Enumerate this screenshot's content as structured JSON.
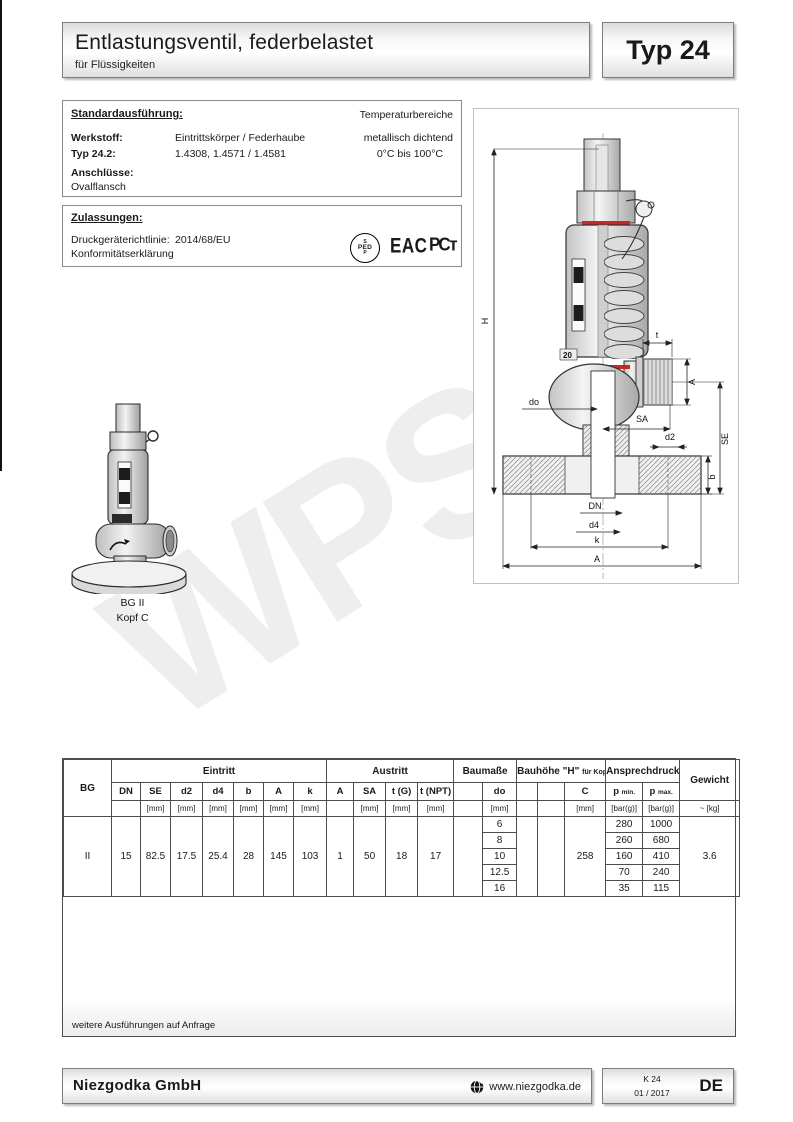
{
  "header": {
    "title": "Entlastungsventil, federbelastet",
    "subtitle": "für Flüssigkeiten",
    "type_label": "Typ 24"
  },
  "standard": {
    "heading": "Standardausführung:",
    "temp_heading": "Temperaturbereiche",
    "werkstoff_label": "Werkstoff:",
    "werkstoff_value": "Eintrittskörper / Federhaube",
    "werkstoff_right": "metallisch dichtend",
    "typ_label": "Typ 24.2:",
    "typ_value": "1.4308, 1.4571 / 1.4581",
    "typ_right": "0°C bis 100°C",
    "anschluesse_label": "Anschlüsse:",
    "anschluesse_value": "Ovalflansch"
  },
  "approvals": {
    "heading": "Zulassungen:",
    "directive_label": "Druckgeräterichtlinie:",
    "directive_value": "2014/68/EU",
    "conformity": "Konformitätserklärung",
    "ped_top": "S",
    "ped_mid": "PED",
    "ped_bottom": "P",
    "eac": "EAC",
    "pct": "РСт"
  },
  "drawing": {
    "labels": {
      "H": "H",
      "t": "t",
      "A_outlet": "A",
      "do": "do",
      "SA": "SA",
      "SE": "SE",
      "d2": "d2",
      "b": "b",
      "DN": "DN",
      "d4": "d4",
      "k": "k",
      "A_bottom": "A",
      "tag": "20"
    }
  },
  "small_drawing": {
    "caption1": "BG II",
    "caption2": "Kopf C"
  },
  "watermark": "WPS",
  "table": {
    "groups": {
      "bg": "BG",
      "eintritt": "Eintritt",
      "austritt": "Austritt",
      "baumasse": "Baumaße",
      "bauhoehe": "Bauhöhe \"H\"",
      "bauhoehe_small": "für Kopf",
      "ansprechdruck": "Ansprechdruck",
      "gewicht": "Gewicht"
    },
    "subs": {
      "dn": "DN",
      "se": "SE",
      "d2": "d2",
      "d4": "d4",
      "b": "b",
      "a": "A",
      "k": "k",
      "a2": "A",
      "sa": "SA",
      "tg": "t (G)",
      "tnpt": "t (NPT)",
      "do": "do",
      "c": "C",
      "pmin_p": "p",
      "pmin_sub": "min.",
      "pmax_p": "p",
      "pmax_sub": "max."
    },
    "units": {
      "mm": "[mm]",
      "bar": "[bar(g)]",
      "kg": "~ [kg]"
    },
    "row": {
      "bg": "II",
      "dn": "15",
      "se": "82.5",
      "d2": "17.5",
      "d4": "25.4",
      "b": "28",
      "a": "145",
      "k": "103",
      "a2": "1",
      "sa": "50",
      "tg": "18",
      "tnpt": "17",
      "c": "258",
      "weight": "3.6"
    },
    "do_values": [
      "6",
      "8",
      "10",
      "12.5",
      "16"
    ],
    "p_min": [
      "280",
      "260",
      "160",
      "70",
      "35"
    ],
    "p_max": [
      "1000",
      "680",
      "410",
      "240",
      "115"
    ],
    "note": "weitere Ausführungen auf Anfrage"
  },
  "footer": {
    "company": "Niezgodka GmbH",
    "website": "www.niezgodka.de",
    "code": "K 24",
    "date": "01 / 2017",
    "lang": "DE"
  }
}
